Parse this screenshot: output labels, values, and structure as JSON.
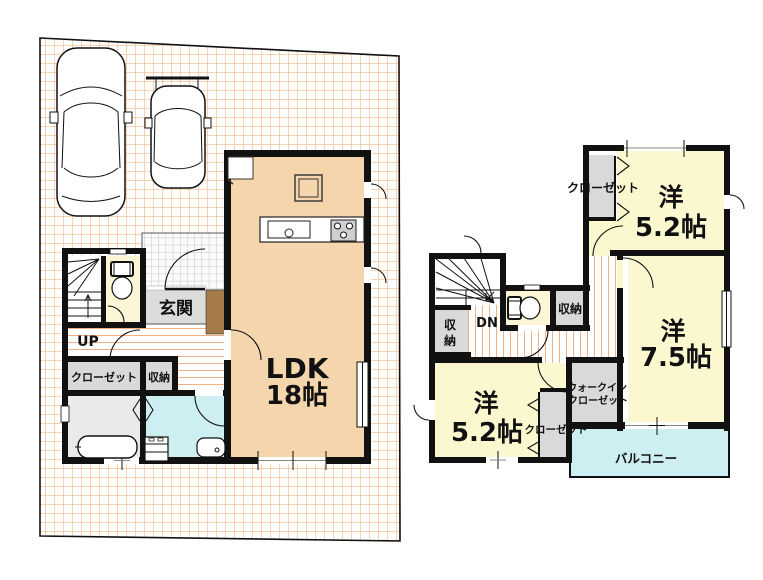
{
  "floor1": {
    "ldk_name": "LDK",
    "ldk_size": "18帖",
    "genkan": "玄関",
    "up": "UP",
    "closet": "クローゼット",
    "storage": "収納"
  },
  "floor2": {
    "closet_top": "クローゼット",
    "room_top_name": "洋",
    "room_top_size": "5.2帖",
    "dn": "DN",
    "storage_left_char1": "収",
    "storage_left_char2": "納",
    "storage_mid": "収納",
    "room_right_name": "洋",
    "room_right_size": "7.5帖",
    "wic_line1": "ウォークイン",
    "wic_line2": "クローゼット",
    "room_bottom_name": "洋",
    "room_bottom_size": "5.2帖",
    "closet_bottom": "クローゼット",
    "balcony": "バルコニー"
  },
  "colors": {
    "wall": "#111111",
    "ldk_floor": "#F4D5AC",
    "room_yellow": "#FBF8D0",
    "closet_gray": "#D9D9D9",
    "water_cyan": "#CDEFF2",
    "bath_gray": "#EAEAEA",
    "genkan_gray": "#DCDCDC",
    "step_brown": "#A57B4A",
    "grid_orange": "#F2A96C",
    "stripe_orange": "#EFB183"
  }
}
